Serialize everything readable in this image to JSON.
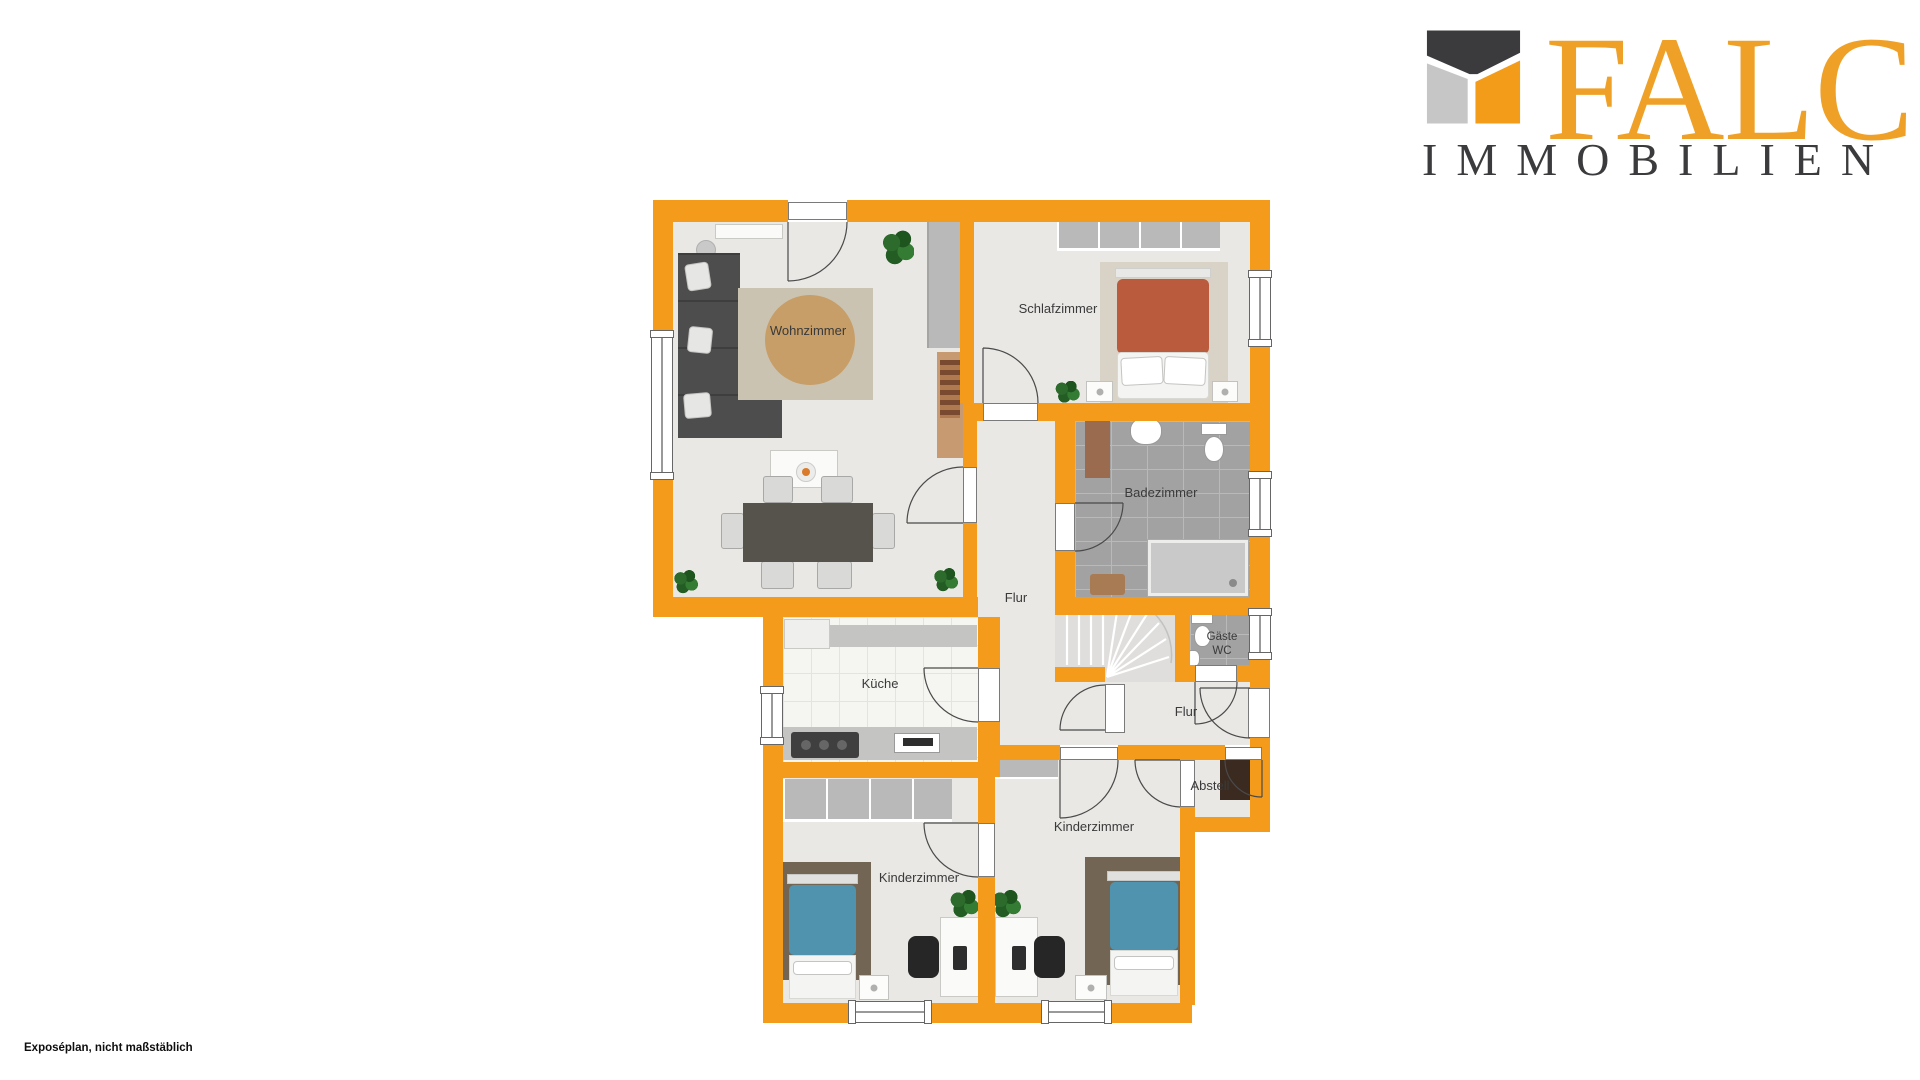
{
  "branding": {
    "company": "FALC",
    "subtitle": "IMMOBILIEN"
  },
  "caption": "Exposéplan, nicht maßstäblich",
  "colors": {
    "wall": "#F49B1B",
    "floor": "#E9E8E5",
    "bath_tile": "#A2A2A2",
    "kitchen_floor": "#F5F5F2",
    "logo_orange": "#EFA127",
    "logo_dark": "#3B3B3D",
    "logo_gray": "#C6C6C6",
    "text_dark": "#3A3A3A",
    "sofa": "#4D4D4D",
    "rug_round": "#C79E67",
    "rug_living": "#CBC3B2",
    "rug_bedroom": "#D8D3C6",
    "rug_kids": "#736553",
    "bed_terracotta": "#B95B3C",
    "bed_teal": "#4F93AF",
    "furniture_gray": "#B9B9B9",
    "counter": "#C4C4C2",
    "wood": "#C89A72",
    "dark_cabinet": "#3A2A20",
    "table_dark": "#56534D",
    "stairs": "#DFDEDC"
  },
  "plan": {
    "labels": [
      {
        "text": "Wohnzimmer",
        "x": 158,
        "y": 136
      },
      {
        "text": "Schlafzimmer",
        "x": 408,
        "y": 114
      },
      {
        "text": "Badezimmer",
        "x": 511,
        "y": 298
      },
      {
        "text": "Flur",
        "x": 366,
        "y": 403
      },
      {
        "text": "Küche",
        "x": 230,
        "y": 489
      },
      {
        "text": "Gäste WC",
        "x": 572,
        "y": 450
      },
      {
        "text": "Flur",
        "x": 536,
        "y": 517
      },
      {
        "text": "Abstell",
        "x": 560,
        "y": 591
      },
      {
        "text": "Kinderzimmer",
        "x": 269,
        "y": 683
      },
      {
        "text": "Kinderzimmer",
        "x": 444,
        "y": 632
      }
    ]
  }
}
